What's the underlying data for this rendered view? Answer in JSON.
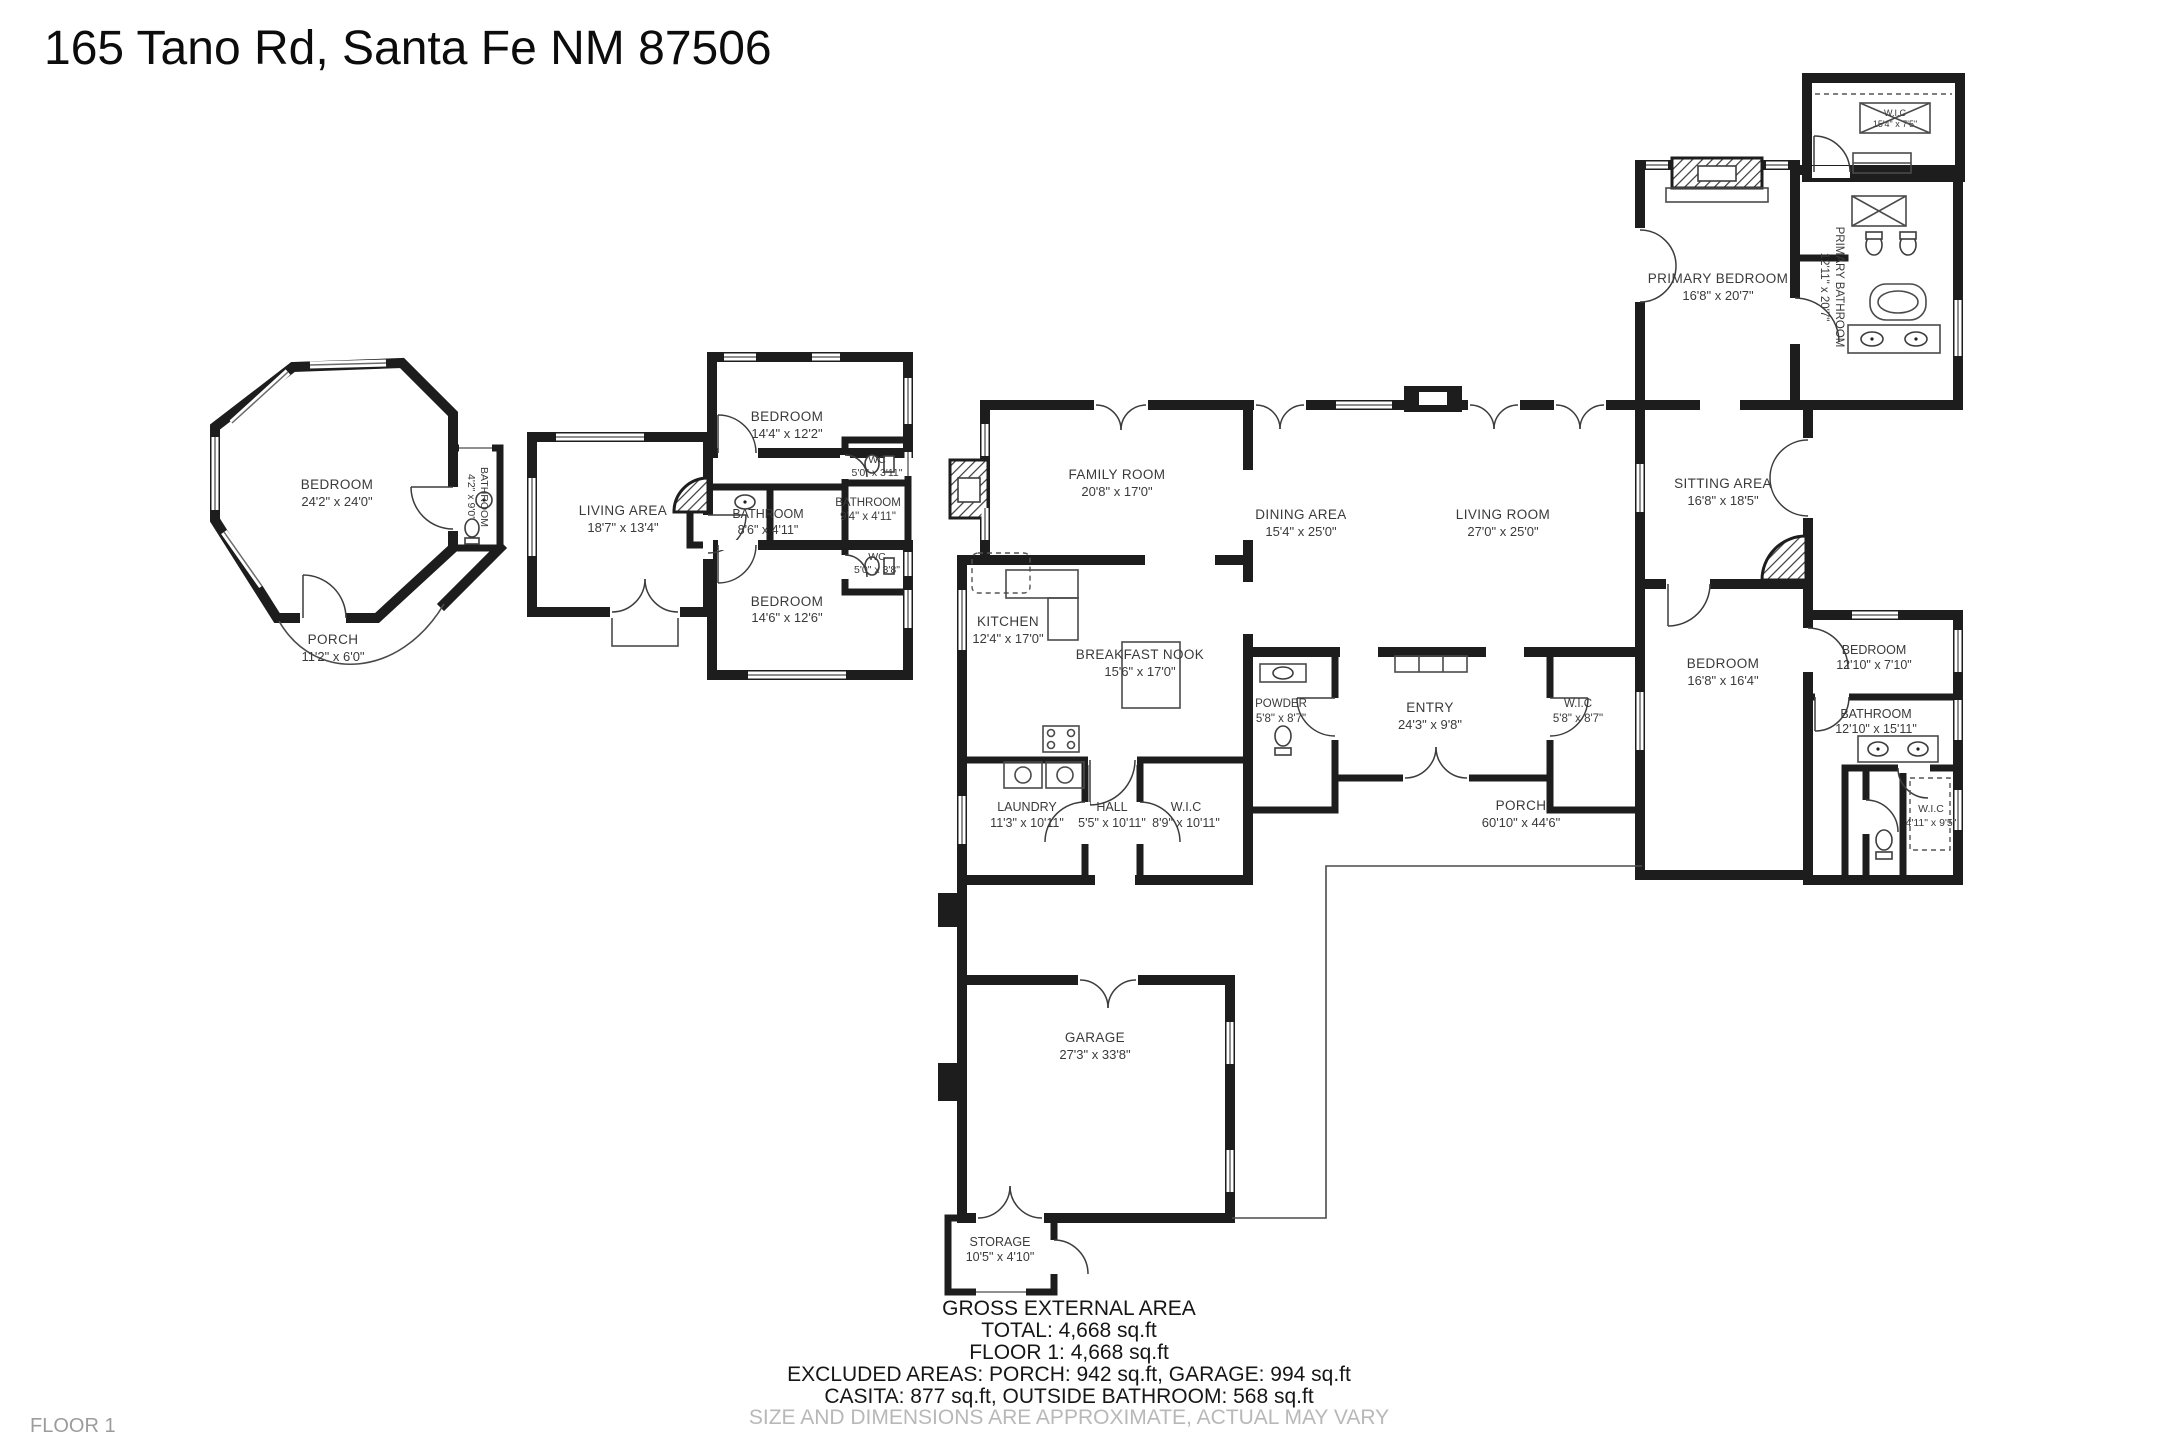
{
  "title": "165 Tano Rd, Santa Fe NM 87506",
  "floor_label": "FLOOR 1",
  "colors": {
    "wall": "#1d1d1d",
    "label": "#3a3a3a",
    "muted": "#b8b8b8"
  },
  "summary": {
    "heading": "GROSS EXTERNAL AREA",
    "total": "TOTAL: 4,668 sq.ft",
    "floor1": "FLOOR 1: 4,668 sq.ft",
    "excluded": "EXCLUDED AREAS: PORCH: 942 sq.ft, GARAGE: 994 sq.ft",
    "casita": "CASITA: 877 sq.ft, OUTSIDE BATHROOM: 568 sq.ft",
    "disclaimer": "SIZE AND DIMENSIONS ARE APPROXIMATE, ACTUAL MAY VARY"
  },
  "rooms": [
    {
      "name": "BEDROOM",
      "dims": "24'2\" x 24'0\""
    },
    {
      "name": "PORCH",
      "dims": "11'2\" x 6'0\""
    },
    {
      "name": "BATHROOM",
      "dims": "4'2\" x 9'0\""
    },
    {
      "name": "LIVING AREA",
      "dims": "18'7\" x 13'4\""
    },
    {
      "name": "BEDROOM",
      "dims": "14'4\" x 12'2\""
    },
    {
      "name": "BATHROOM",
      "dims": "8'6\" x 4'11\""
    },
    {
      "name": "BATHROOM",
      "dims": "9'4\" x 4'11\""
    },
    {
      "name": "WC",
      "dims": "5'0\" x 3'11\""
    },
    {
      "name": "WC",
      "dims": "5'0\" x 3'8\""
    },
    {
      "name": "BEDROOM",
      "dims": "14'6\" x 12'6\""
    },
    {
      "name": "FAMILY ROOM",
      "dims": "20'8\" x 17'0\""
    },
    {
      "name": "DINING AREA",
      "dims": "15'4\" x 25'0\""
    },
    {
      "name": "LIVING ROOM",
      "dims": "27'0\" x 25'0\""
    },
    {
      "name": "KITCHEN",
      "dims": "12'4\" x 17'0\""
    },
    {
      "name": "BREAKFAST NOOK",
      "dims": "15'6\" x 17'0\""
    },
    {
      "name": "POWDER",
      "dims": "5'8\" x 8'7\""
    },
    {
      "name": "ENTRY",
      "dims": "24'3\" x 9'8\""
    },
    {
      "name": "W.I.C",
      "dims": "5'8\" x 8'7\""
    },
    {
      "name": "LAUNDRY",
      "dims": "11'3\" x 10'11\""
    },
    {
      "name": "HALL",
      "dims": "5'5\" x 10'11\""
    },
    {
      "name": "W.I.C",
      "dims": "8'9\" x 10'11\""
    },
    {
      "name": "PRIMARY BEDROOM",
      "dims": "16'8\" x 20'7\""
    },
    {
      "name": "PRIMARY BATHROOM",
      "dims": "12'11\" x 20'7\""
    },
    {
      "name": "W.I.C",
      "dims": "15'4\" x 7'5\""
    },
    {
      "name": "SITTING AREA",
      "dims": "16'8\" x 18'5\""
    },
    {
      "name": "BEDROOM",
      "dims": "16'8\" x 16'4\""
    },
    {
      "name": "BEDROOM",
      "dims": "12'10\" x 7'10\""
    },
    {
      "name": "BATHROOM",
      "dims": "12'10\" x 15'11\""
    },
    {
      "name": "W.I.C",
      "dims": "4'11\" x 9'5\""
    },
    {
      "name": "PORCH",
      "dims": "60'10\" x 44'6\""
    },
    {
      "name": "GARAGE",
      "dims": "27'3\" x 33'8\""
    },
    {
      "name": "STORAGE",
      "dims": "10'5\" x 4'10\""
    }
  ]
}
